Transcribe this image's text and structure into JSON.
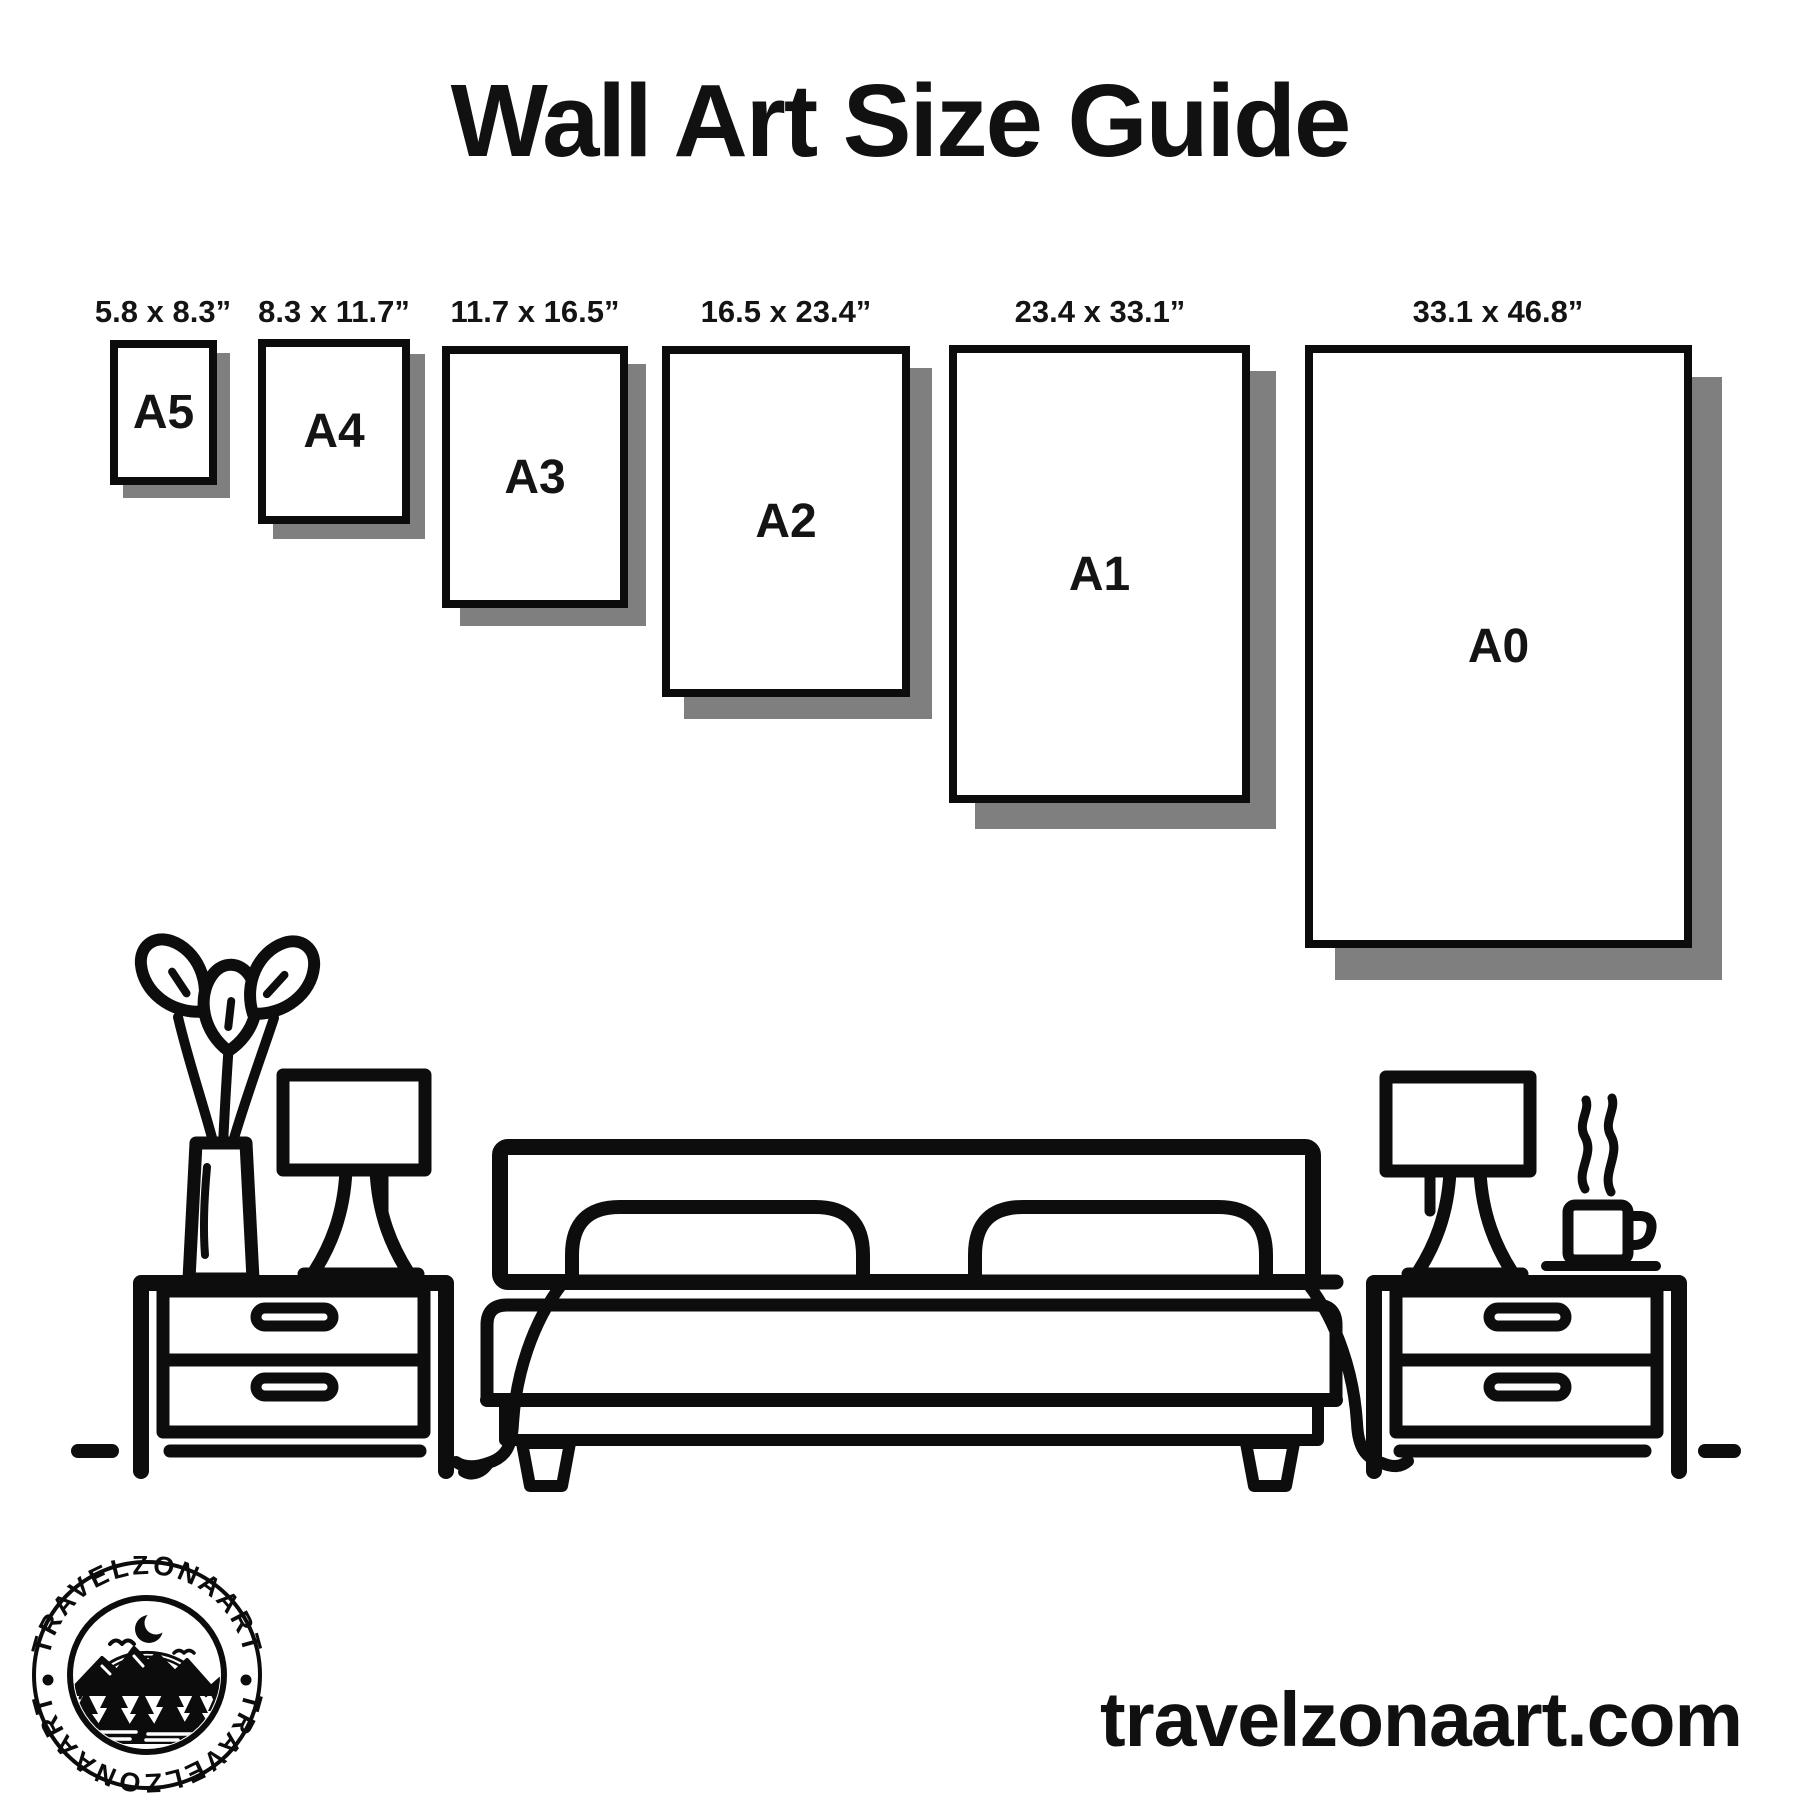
{
  "title": "Wall Art Size Guide",
  "sizes": [
    {
      "name": "A5",
      "dimensions": "5.8 x 8.3”"
    },
    {
      "name": "A4",
      "dimensions": "8.3 x 11.7”"
    },
    {
      "name": "A3",
      "dimensions": "11.7 x 16.5”"
    },
    {
      "name": "A2",
      "dimensions": "16.5 x 23.4”"
    },
    {
      "name": "A1",
      "dimensions": "23.4 x 33.1”"
    },
    {
      "name": "A0",
      "dimensions": "33.1 x 46.8”"
    }
  ],
  "logo": {
    "brand": "TRAVELZONAART",
    "separator": "•"
  },
  "website": {
    "url": "travelzonaart.com"
  },
  "colors": {
    "ink": "#0c0c0c",
    "shadow": "#7f7f7f",
    "background": "#ffffff"
  }
}
